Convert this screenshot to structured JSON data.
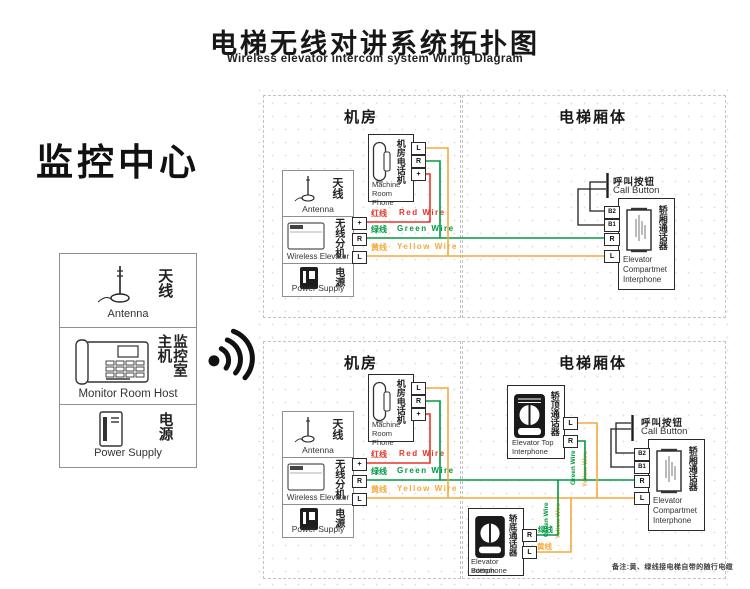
{
  "header": {
    "title_zh": "电梯无线对讲系统拓扑图",
    "title_en": "Wireless elevator intercom system Wiring Diagram"
  },
  "monitor_center": {
    "title": "监控中心",
    "antenna_zh": "天线",
    "antenna_en": "Antenna",
    "host_zh": "监控室主机",
    "host_en": "Monitor Room Host",
    "power_zh": "电源",
    "power_en": "Power Supply"
  },
  "sections": {
    "machine_room_title": "机房",
    "car_body_title": "电梯厢体"
  },
  "station": {
    "antenna_zh": "天线",
    "antenna_en": "Antenna",
    "wireless_zh": "无线分机",
    "wireless_en": "Wireless Elevator",
    "power_zh": "电源",
    "power_en": "Power Supply"
  },
  "phone": {
    "zh": "机房电话机",
    "en_line1": "Machine",
    "en_line2": "Room Phone"
  },
  "compartment": {
    "zh": "轿厢通话器",
    "en_line1": "Elevator",
    "en_line2": "Compartmet",
    "en_line3": "Interphone"
  },
  "top_interphone": {
    "zh": "轿顶通话器",
    "en_line1": "Elevator Top",
    "en_line2": "Interphone"
  },
  "bottom_interphone": {
    "zh": "轿底通话器",
    "en_line1": "Elevator Bottom",
    "en_line2": "Interphone"
  },
  "call_button": {
    "zh": "呼叫按钮",
    "en": "Call Button"
  },
  "wires": {
    "red_zh": "红线",
    "red_en": "Red Wire",
    "green_zh": "绿线",
    "green_en": "Green Wire",
    "yellow_zh": "黄线",
    "yellow_en": "Yellow Wire"
  },
  "terminals": {
    "plus": "+",
    "r": "R",
    "l": "L",
    "b1": "B1",
    "b2": "B2"
  },
  "note": "备注:黄、绿线接电梯自带的随行电缆",
  "colors": {
    "red": "#e5352b",
    "green": "#009944",
    "yellow": "#f5a93b",
    "line_dark": "#1f1f1f"
  }
}
